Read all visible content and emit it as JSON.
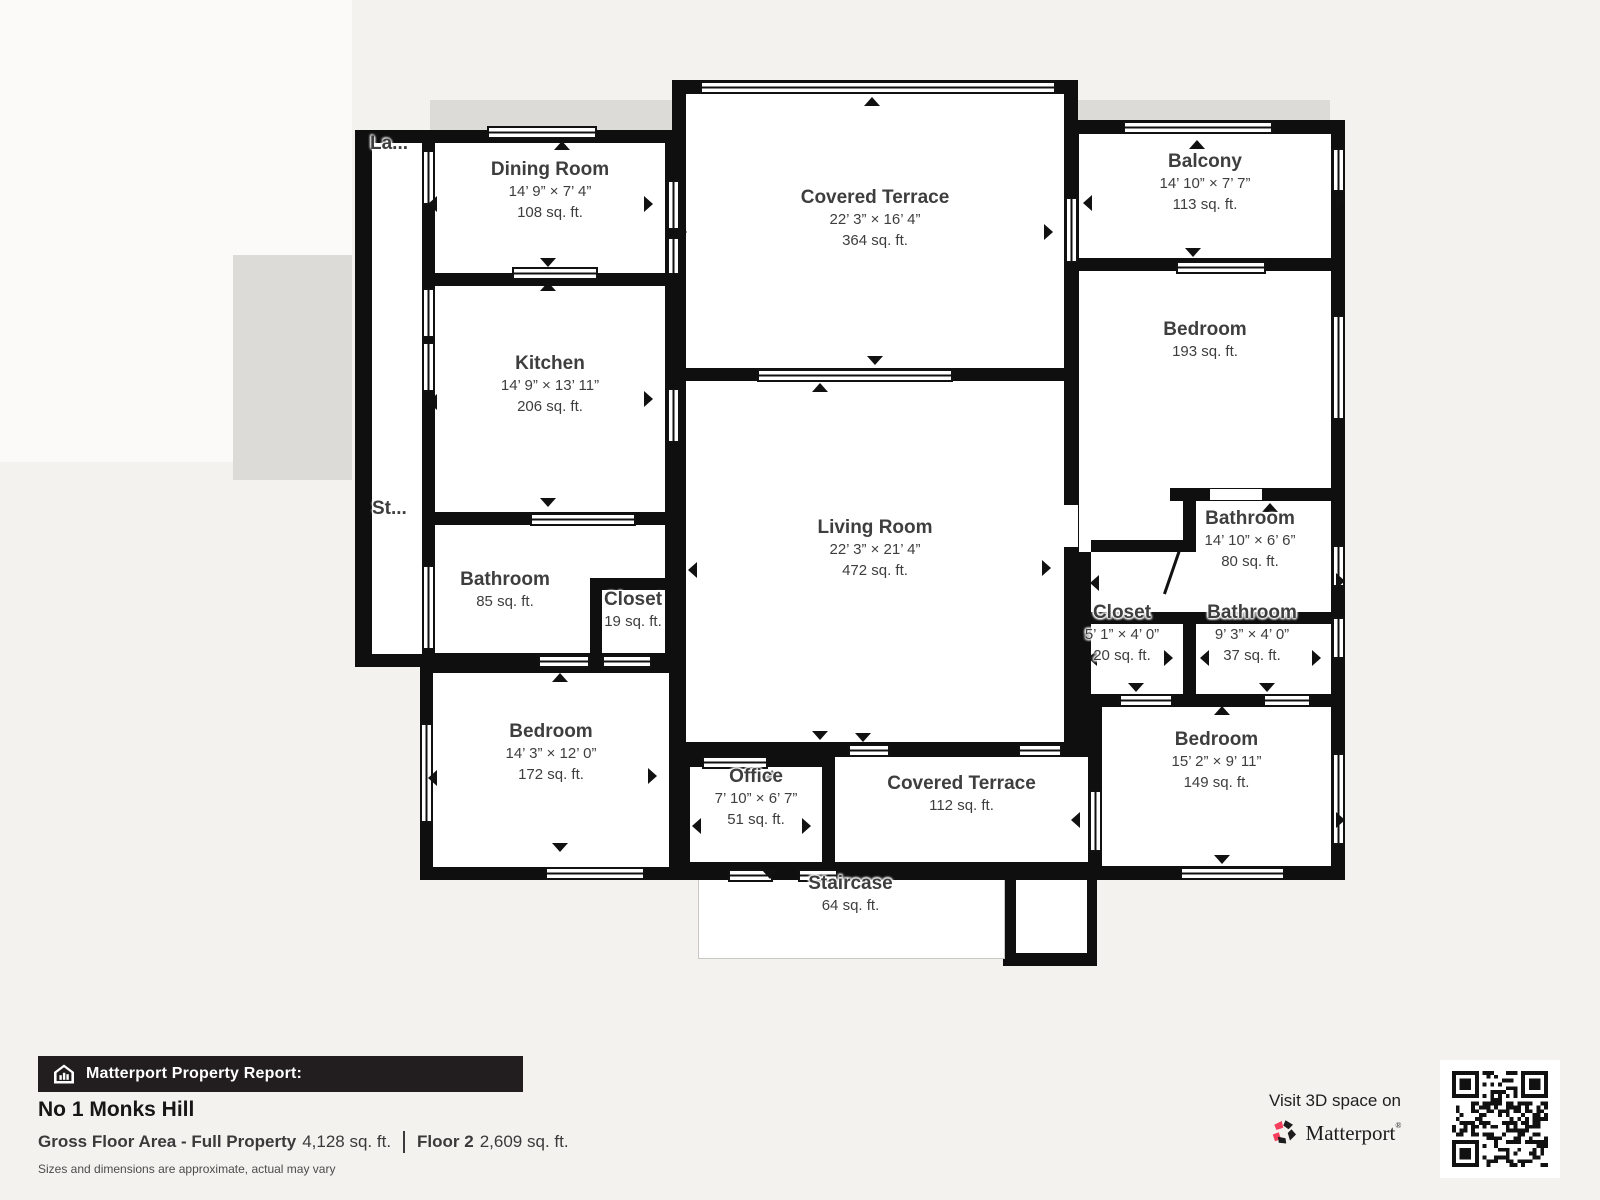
{
  "plan": {
    "rooms": [
      {
        "key": "laundry-truncated",
        "label": "La..."
      },
      {
        "key": "stairs-truncated",
        "label": "St..."
      },
      {
        "key": "dining-room",
        "label": "Dining Room",
        "dims": "14’ 9” × 7’ 4”",
        "area": "108 sq. ft."
      },
      {
        "key": "kitchen",
        "label": "Kitchen",
        "dims": "14’ 9” × 13’ 11”",
        "area": "206 sq. ft."
      },
      {
        "key": "bathroom-85",
        "label": "Bathroom",
        "area": "85 sq. ft."
      },
      {
        "key": "closet-19",
        "label": "Closet",
        "area": "19 sq. ft."
      },
      {
        "key": "bedroom-172",
        "label": "Bedroom",
        "dims": "14’ 3” × 12’ 0”",
        "area": "172 sq. ft."
      },
      {
        "key": "covered-terrace-364",
        "label": "Covered Terrace",
        "dims": "22’ 3” × 16’ 4”",
        "area": "364 sq. ft."
      },
      {
        "key": "living-room",
        "label": "Living Room",
        "dims": "22’ 3” × 21’ 4”",
        "area": "472 sq. ft."
      },
      {
        "key": "office",
        "label": "Office",
        "dims": "7’ 10” × 6’ 7”",
        "area": "51 sq. ft."
      },
      {
        "key": "covered-terrace-112",
        "label": "Covered Terrace",
        "area": "112 sq. ft."
      },
      {
        "key": "staircase",
        "label": "Staircase",
        "area": "64 sq. ft."
      },
      {
        "key": "balcony",
        "label": "Balcony",
        "dims": "14’ 10” × 7’ 7”",
        "area": "113 sq. ft."
      },
      {
        "key": "bedroom-193",
        "label": "Bedroom",
        "area": "193 sq. ft."
      },
      {
        "key": "bathroom-80",
        "label": "Bathroom",
        "dims": "14’ 10” × 6’ 6”",
        "area": "80 sq. ft."
      },
      {
        "key": "closet-20",
        "label": "Closet",
        "dims": "5’ 1” × 4’ 0”",
        "area": "20 sq. ft."
      },
      {
        "key": "bathroom-37",
        "label": "Bathroom",
        "dims": "9’ 3” × 4’ 0”",
        "area": "37 sq. ft."
      },
      {
        "key": "bedroom-149",
        "label": "Bedroom",
        "dims": "15’ 2” × 9’ 11”",
        "area": "149 sq. ft."
      }
    ]
  },
  "footer": {
    "report_label": "Matterport Property Report:",
    "property_name": "No 1 Monks Hill",
    "gross_label": "Gross Floor Area - Full Property",
    "gross_value": "4,128 sq. ft.",
    "floor_label": "Floor 2",
    "floor_value": "2,609 sq. ft.",
    "disclaimer": "Sizes and dimensions are approximate, actual may vary",
    "visit_label": "Visit 3D space on",
    "brand": "Matterport",
    "brand_reg": "®"
  },
  "colors": {
    "wall": "#0f0f0f",
    "background": "#f4f2ef",
    "room_fill": "#ffffff",
    "label_text": "#3e3e3e",
    "footer_bar": "#221e1f",
    "brand_pink": "#f43e5c"
  }
}
